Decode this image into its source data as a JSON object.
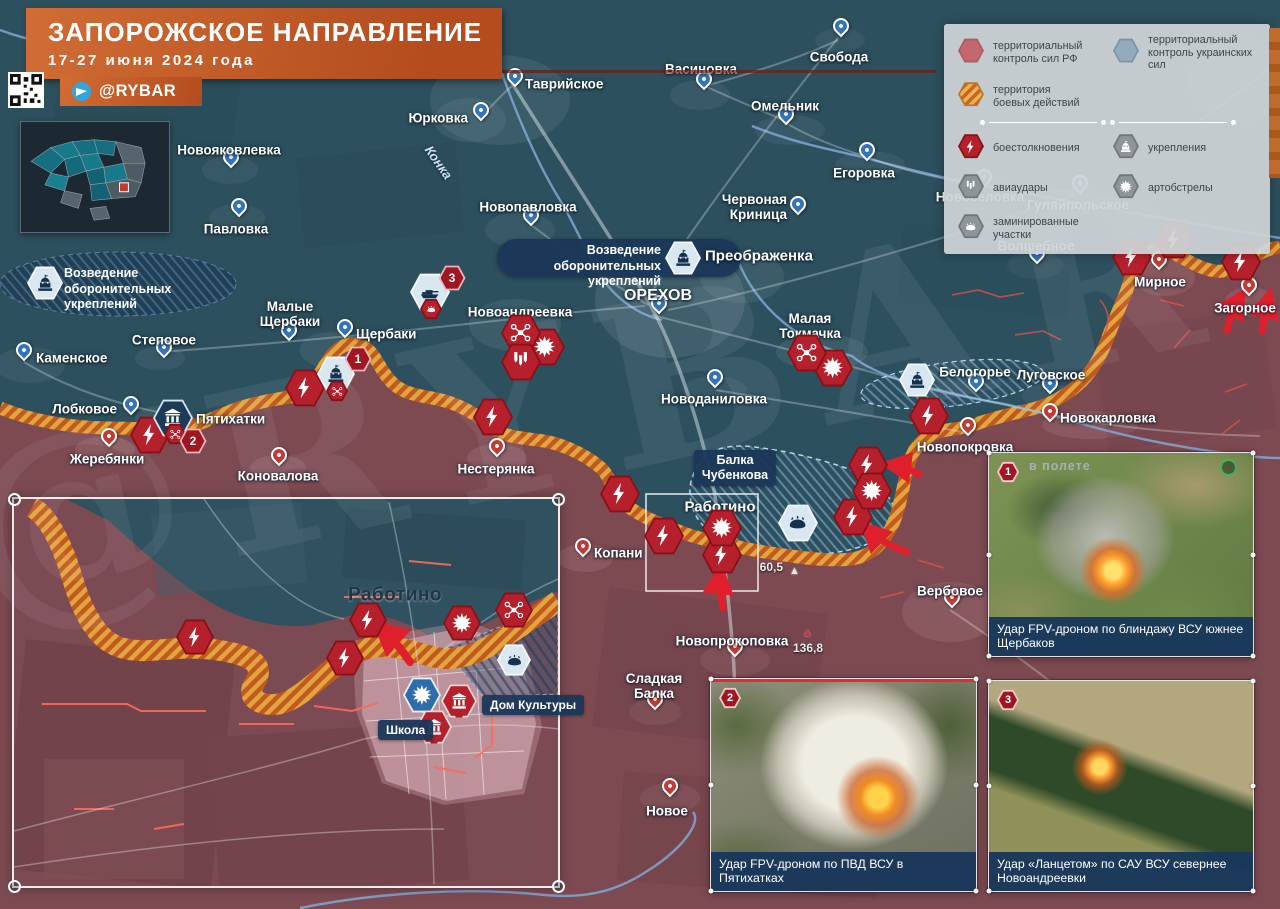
{
  "title": {
    "heading": "ЗАПОРОЖСКОЕ НАПРАВЛЕНИЕ",
    "date_range": "17-27 июня 2024 года",
    "channel": "@RYBAR"
  },
  "watermark": "@RYBAR",
  "legend": {
    "territory": [
      {
        "style": "rf",
        "label": "территориальный\nконтроль сил РФ"
      },
      {
        "style": "ua",
        "label": "территориальный\nконтроль украинских сил"
      },
      {
        "style": "combat",
        "label": "территория\nбоевых действий"
      }
    ],
    "symbols": [
      {
        "type": "lightning",
        "style": "red",
        "label": "боестолкновения"
      },
      {
        "type": "fort",
        "style": "grey",
        "label": "укрепления"
      },
      {
        "type": "bombs",
        "style": "grey",
        "label": "авиаудары"
      },
      {
        "type": "explosion",
        "style": "grey",
        "label": "артобстрелы"
      },
      {
        "type": "mine",
        "style": "grey",
        "label": "заминированные участки"
      }
    ]
  },
  "map": {
    "fort_label": "Возведение\nоборонительных укреплений",
    "balka_label": "Балка\nЧубенкова",
    "river_label": "Конка",
    "inset": {
      "town_label": "Работино",
      "dk_label": "Дом Культуры",
      "school_label": "Школа"
    },
    "heights": [
      {
        "value": "60,5",
        "lx": 783,
        "ly": 567,
        "la": "r",
        "tx": 789,
        "ty": 566,
        "tc": "#e6eaec"
      },
      {
        "value": "136,8",
        "lx": 808,
        "ly": 648,
        "la": "c",
        "tx": 802,
        "ty": 628,
        "tc": "#d5303a"
      }
    ],
    "settlements": [
      {
        "n": "Свобода",
        "px": 839,
        "py": 33,
        "pin": "b",
        "lx": 839,
        "ly": 57,
        "la": "c"
      },
      {
        "n": "Васиновка",
        "px": 702,
        "py": 86,
        "pin": "b",
        "lx": 701,
        "ly": 69,
        "la": "c"
      },
      {
        "n": "Таврийское",
        "px": 513,
        "py": 83,
        "pin": "b",
        "lx": 525,
        "ly": 84,
        "la": "l"
      },
      {
        "n": "Юрковка",
        "px": 479,
        "py": 117,
        "pin": "b",
        "lx": 468,
        "ly": 118,
        "la": "r"
      },
      {
        "n": "Новопавловка",
        "px": 529,
        "py": 222,
        "pin": "b",
        "lx": 528,
        "ly": 207,
        "la": "c"
      },
      {
        "n": "Омельник",
        "px": 784,
        "py": 121,
        "pin": "b",
        "lx": 785,
        "ly": 106,
        "la": "c"
      },
      {
        "n": "Егоровка",
        "px": 865,
        "py": 157,
        "pin": "b",
        "lx": 864,
        "ly": 173,
        "la": "c"
      },
      {
        "n": "Червоная\nКриница",
        "px": 796,
        "py": 211,
        "pin": "b",
        "lx": 787,
        "ly": 207,
        "la": "r"
      },
      {
        "n": "Новоселовка",
        "px": 982,
        "py": 184,
        "pin": "b",
        "lx": 980,
        "ly": 197,
        "la": "c"
      },
      {
        "n": "Гуляйпольское",
        "px": 1078,
        "py": 190,
        "pin": "b",
        "lx": 1078,
        "ly": 205,
        "la": "c"
      },
      {
        "n": "Волшебное",
        "px": 1035,
        "py": 260,
        "pin": "b",
        "lx": 1036,
        "ly": 246,
        "la": "c"
      },
      {
        "n": "Павловка",
        "px": 237,
        "py": 213,
        "pin": "b",
        "lx": 236,
        "ly": 229,
        "la": "c"
      },
      {
        "n": "Новояковлевка",
        "px": 229,
        "py": 164,
        "pin": "b",
        "lx": 229,
        "ly": 150,
        "la": "c"
      },
      {
        "n": "Каменское",
        "px": 22,
        "py": 357,
        "pin": "b",
        "lx": 36,
        "ly": 358,
        "la": "l"
      },
      {
        "n": "Степовое",
        "px": 162,
        "py": 354,
        "pin": "b",
        "lx": 164,
        "ly": 340,
        "la": "c"
      },
      {
        "n": "Лобковое",
        "px": 129,
        "py": 411,
        "pin": "b",
        "lx": 117,
        "ly": 409,
        "la": "r"
      },
      {
        "n": "Малые\nЩербаки",
        "px": 287,
        "py": 337,
        "pin": "b",
        "lx": 290,
        "ly": 314,
        "la": "c"
      },
      {
        "n": "Щербаки",
        "px": 343,
        "py": 334,
        "pin": "b",
        "lx": 356,
        "ly": 334,
        "la": "l"
      },
      {
        "n": "Нестерянка",
        "px": 495,
        "py": 453,
        "pin": "r",
        "lx": 496,
        "ly": 469,
        "la": "c"
      },
      {
        "n": "ОРЕХОВ",
        "px": 657,
        "py": 310,
        "pin": "b",
        "lx": 658,
        "ly": 296,
        "la": "c",
        "fs": 16
      },
      {
        "n": "Новоандреевка",
        "px": null,
        "py": null,
        "pin": null,
        "lx": 520,
        "ly": 312,
        "la": "c"
      },
      {
        "n": "Малая\nТокмачка",
        "px": null,
        "py": null,
        "pin": null,
        "lx": 810,
        "ly": 326,
        "la": "c"
      },
      {
        "n": "Новоданиловка",
        "px": 713,
        "py": 384,
        "pin": "b",
        "lx": 714,
        "ly": 399,
        "la": "c"
      },
      {
        "n": "Преображенка",
        "px": null,
        "py": null,
        "pin": null,
        "lx": 705,
        "ly": 257,
        "la": "l",
        "fs": 15
      },
      {
        "n": "Белогорье",
        "px": 974,
        "py": 388,
        "pin": "b",
        "lx": 975,
        "ly": 372,
        "la": "c"
      },
      {
        "n": "Луговское",
        "px": 1048,
        "py": 390,
        "pin": "b",
        "lx": 1051,
        "ly": 375,
        "la": "c"
      },
      {
        "n": "Новокарловка",
        "px": 1048,
        "py": 418,
        "pin": "r",
        "lx": 1060,
        "ly": 418,
        "la": "l"
      },
      {
        "n": "Новопокровка",
        "px": 966,
        "py": 432,
        "pin": "r",
        "lx": 965,
        "ly": 447,
        "la": "c"
      },
      {
        "n": "Мирное",
        "px": 1157,
        "py": 266,
        "pin": "r",
        "lx": 1160,
        "ly": 282,
        "la": "c"
      },
      {
        "n": "Загорное",
        "px": 1247,
        "py": 292,
        "pin": "r",
        "lx": 1245,
        "ly": 308,
        "la": "c"
      },
      {
        "n": "Жеребянки",
        "px": 107,
        "py": 443,
        "pin": "r",
        "lx": 107,
        "ly": 459,
        "la": "c"
      },
      {
        "n": "Коновалова",
        "px": 277,
        "py": 462,
        "pin": "r",
        "lx": 278,
        "ly": 476,
        "la": "c"
      },
      {
        "n": "Пятихатки",
        "px": null,
        "py": null,
        "pin": null,
        "lx": 196,
        "ly": 419,
        "la": "l"
      },
      {
        "n": "Копани",
        "px": 581,
        "py": 553,
        "pin": "r",
        "lx": 594,
        "ly": 553,
        "la": "l"
      },
      {
        "n": "Вербовое",
        "px": 950,
        "py": 604,
        "pin": "r",
        "lx": 950,
        "ly": 591,
        "la": "c"
      },
      {
        "n": "Новопрокоповка",
        "px": 733,
        "py": 653,
        "pin": "r",
        "lx": 732,
        "ly": 641,
        "la": "c"
      },
      {
        "n": "Сладкая\nБалка",
        "px": 653,
        "py": 706,
        "pin": "r",
        "lx": 654,
        "ly": 686,
        "la": "c"
      },
      {
        "n": "Новое",
        "px": 668,
        "py": 793,
        "pin": "r",
        "lx": 667,
        "ly": 811,
        "la": "c"
      },
      {
        "n": "Работино",
        "px": null,
        "py": null,
        "pin": null,
        "lx": 720,
        "ly": 508,
        "la": "c",
        "fs": 15
      },
      {
        "n": "Работино",
        "px": null,
        "py": null,
        "pin": null,
        "lx": 395,
        "ly": 595,
        "la": "c",
        "dk": true
      }
    ],
    "icons": [
      {
        "t": "lightning",
        "s": "red",
        "x": 150,
        "y": 435
      },
      {
        "t": "lightning",
        "s": "red",
        "x": 305,
        "y": 388
      },
      {
        "t": "lightning",
        "s": "red",
        "x": 493,
        "y": 417
      },
      {
        "t": "lightning",
        "s": "red",
        "x": 620,
        "y": 494
      },
      {
        "t": "lightning",
        "s": "red",
        "x": 664,
        "y": 536
      },
      {
        "t": "lightning",
        "s": "red",
        "x": 722,
        "y": 555
      },
      {
        "t": "lightning",
        "s": "red",
        "x": 868,
        "y": 465
      },
      {
        "t": "lightning",
        "s": "red",
        "x": 853,
        "y": 517
      },
      {
        "t": "lightning",
        "s": "red",
        "x": 929,
        "y": 416
      },
      {
        "t": "lightning",
        "s": "red",
        "x": 1132,
        "y": 257
      },
      {
        "t": "lightning",
        "s": "red",
        "x": 1174,
        "y": 240
      },
      {
        "t": "lightning",
        "s": "red",
        "x": 1241,
        "y": 262
      },
      {
        "t": "explosion",
        "s": "red",
        "x": 872,
        "y": 491
      },
      {
        "t": "explosion",
        "s": "red",
        "x": 833,
        "y": 368
      },
      {
        "t": "explosion",
        "s": "red",
        "x": 545,
        "y": 347
      },
      {
        "t": "explosion",
        "s": "red",
        "x": 722,
        "y": 528
      },
      {
        "t": "drone",
        "s": "red",
        "x": 807,
        "y": 353
      },
      {
        "t": "drone",
        "s": "red",
        "x": 521,
        "y": 333
      },
      {
        "t": "bombs",
        "s": "red",
        "x": 521,
        "y": 362
      },
      {
        "t": "mine",
        "s": "light",
        "x": 798,
        "y": 523
      },
      {
        "t": "fort",
        "s": "light",
        "x": 45,
        "y": 283,
        "z": 36
      },
      {
        "t": "fort",
        "s": "light",
        "x": 683,
        "y": 258,
        "z": 36
      },
      {
        "t": "fort",
        "s": "light",
        "x": 917,
        "y": 380,
        "z": 36
      },
      {
        "t": "fort",
        "s": "light",
        "x": 336,
        "y": 374,
        "z": 38
      },
      {
        "t": "building",
        "s": "navy",
        "x": 173,
        "y": 418,
        "z": 40
      },
      {
        "t": "tank",
        "s": "light",
        "x": 430,
        "y": 292,
        "z": 40
      },
      {
        "t": "mine",
        "s": "red",
        "x": 431,
        "y": 309,
        "z": 22
      },
      {
        "t": "drone",
        "s": "red",
        "x": 337,
        "y": 391,
        "z": 22
      },
      {
        "t": "drone",
        "s": "red",
        "x": 175,
        "y": 434,
        "z": 22
      },
      {
        "t": "lightning",
        "s": "red",
        "x": 195,
        "y": 637,
        "z": 38
      },
      {
        "t": "lightning",
        "s": "red",
        "x": 368,
        "y": 620,
        "z": 38
      },
      {
        "t": "lightning",
        "s": "red",
        "x": 345,
        "y": 658,
        "z": 38
      },
      {
        "t": "explosion",
        "s": "red",
        "x": 462,
        "y": 623,
        "z": 38
      },
      {
        "t": "drone",
        "s": "red",
        "x": 514,
        "y": 610,
        "z": 38
      },
      {
        "t": "explosion",
        "s": "blue",
        "x": 422,
        "y": 695,
        "z": 38
      },
      {
        "t": "mine",
        "s": "light",
        "x": 514,
        "y": 660,
        "z": 34
      },
      {
        "t": "building",
        "s": "redpin",
        "x": 459,
        "y": 701,
        "z": 36
      },
      {
        "t": "building",
        "s": "redpin",
        "x": 434,
        "y": 727,
        "z": 36
      }
    ],
    "numbered": [
      {
        "n": "1",
        "x": 358,
        "y": 359
      },
      {
        "n": "2",
        "x": 193,
        "y": 441
      },
      {
        "n": "3",
        "x": 452,
        "y": 278
      }
    ],
    "photos": [
      {
        "marker": "1",
        "caption": "Удар FPV-дроном по блиндажу ВСУ южнее Щербаков",
        "overlay": "в полете"
      },
      {
        "marker": "2",
        "caption": "Удар FPV-дроном по ПВД ВСУ в Пятихатках"
      },
      {
        "marker": "3",
        "caption": "Удар «Ланцетом» по САУ ВСУ севернее Новоандреевки"
      }
    ]
  }
}
